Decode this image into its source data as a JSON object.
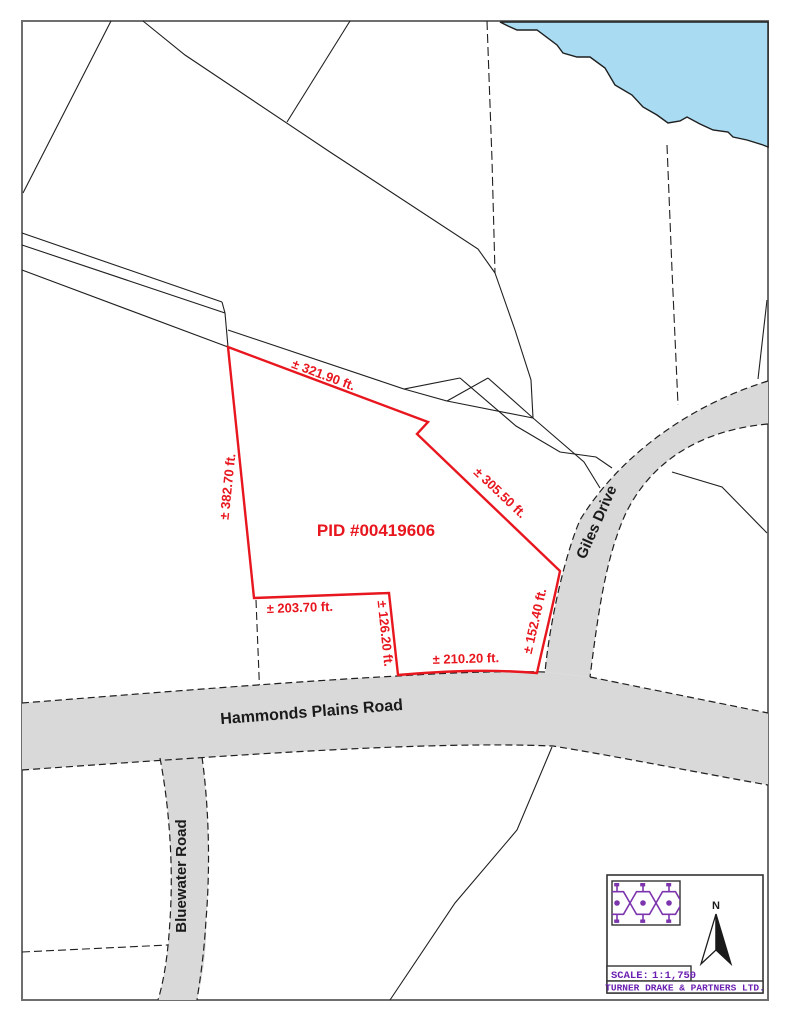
{
  "map": {
    "title": "Survey location plan",
    "pid_label": "PID #00419606",
    "dimensions": {
      "north": "± 321.90 ft.",
      "west": "± 382.70 ft.",
      "northeast": "± 305.50 ft.",
      "southwest": "± 203.70 ft.",
      "jog": "± 126.20 ft.",
      "south": "± 210.20 ft.",
      "southeast": "± 152.40 ft."
    },
    "roads": {
      "hammonds_plains": "Hammonds Plains Road",
      "giles": "Giles Drive",
      "bluewater": "Bluewater Road"
    },
    "colors": {
      "parcel_red": "#E8161E",
      "road_gray": "#D9D9D9",
      "water_blue": "#A9DCF2",
      "line_black": "#1f1f1f",
      "brand_purple": "#6A1FB0",
      "logo_purple": "#7C35AD"
    },
    "legend": {
      "north_label": "N",
      "scale_label": "SCALE:",
      "scale_value": "1:1,750",
      "company": "TURNER DRAKE & PARTNERS LTD.",
      "icons": [
        "honeycomb-logo",
        "north-arrow"
      ]
    }
  }
}
